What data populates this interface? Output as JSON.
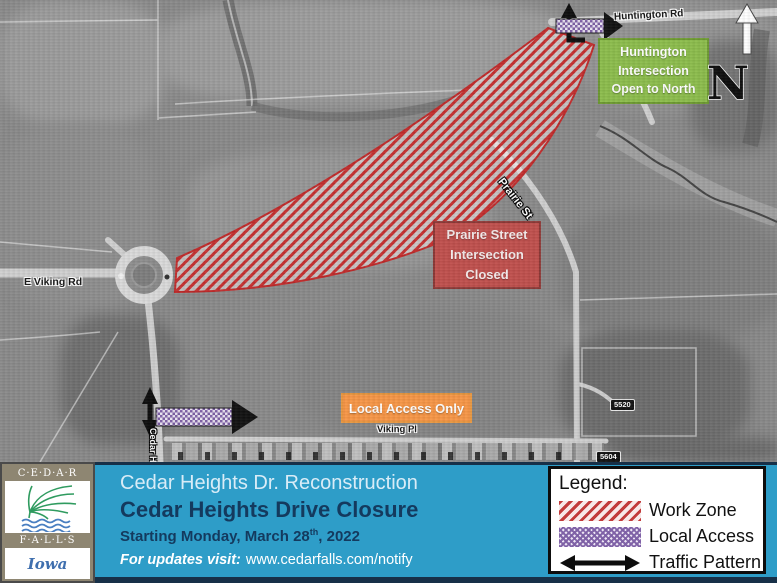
{
  "banner": {
    "title": "Cedar Heights Dr. Reconstruction",
    "subtitle": "Cedar Heights Drive Closure",
    "date_prefix": "Starting Monday, March 28",
    "date_sup": "th",
    "date_suffix": ", 2022",
    "updates_label": "For updates visit:",
    "updates_url": "www.cedarfalls.com/notify",
    "bar_color": "#2e9dc8",
    "title_dark_color": "#143a5e"
  },
  "logo": {
    "line1": "C·E·D·A·R",
    "line2": "F·A·L·L·S",
    "line3": "Iowa"
  },
  "legend": {
    "heading": "Legend:",
    "items": [
      {
        "label": "Work Zone",
        "swatch": "red-diagonal-hatch"
      },
      {
        "label": "Local Access",
        "swatch": "purple-checker"
      },
      {
        "label": "Traffic Pattern",
        "swatch": "black-double-arrow"
      }
    ]
  },
  "map": {
    "callouts": {
      "huntington": {
        "line1": "Huntington",
        "line2": "Intersection",
        "line3": "Open to North",
        "fill": "#8cbd4c"
      },
      "prairie": {
        "line1": "Prairie Street",
        "line2": "Intersection",
        "line3": "Closed",
        "fill": "#c0504d"
      },
      "local_access": {
        "text": "Local Access Only",
        "fill": "#f79646"
      }
    },
    "streets": {
      "huntington_rd": "Huntington Rd",
      "prairie_st": "Prairie St",
      "e_viking_rd": "E Viking Rd",
      "viking_pl": "Viking Pl",
      "cedar_hts_dr": "Cedar Hts Dr"
    },
    "addresses": {
      "a5520": "5520",
      "a5604": "5604"
    },
    "north": "N",
    "work_zone_color": "#c02a2a",
    "local_access_color": "#7d5fa5"
  }
}
